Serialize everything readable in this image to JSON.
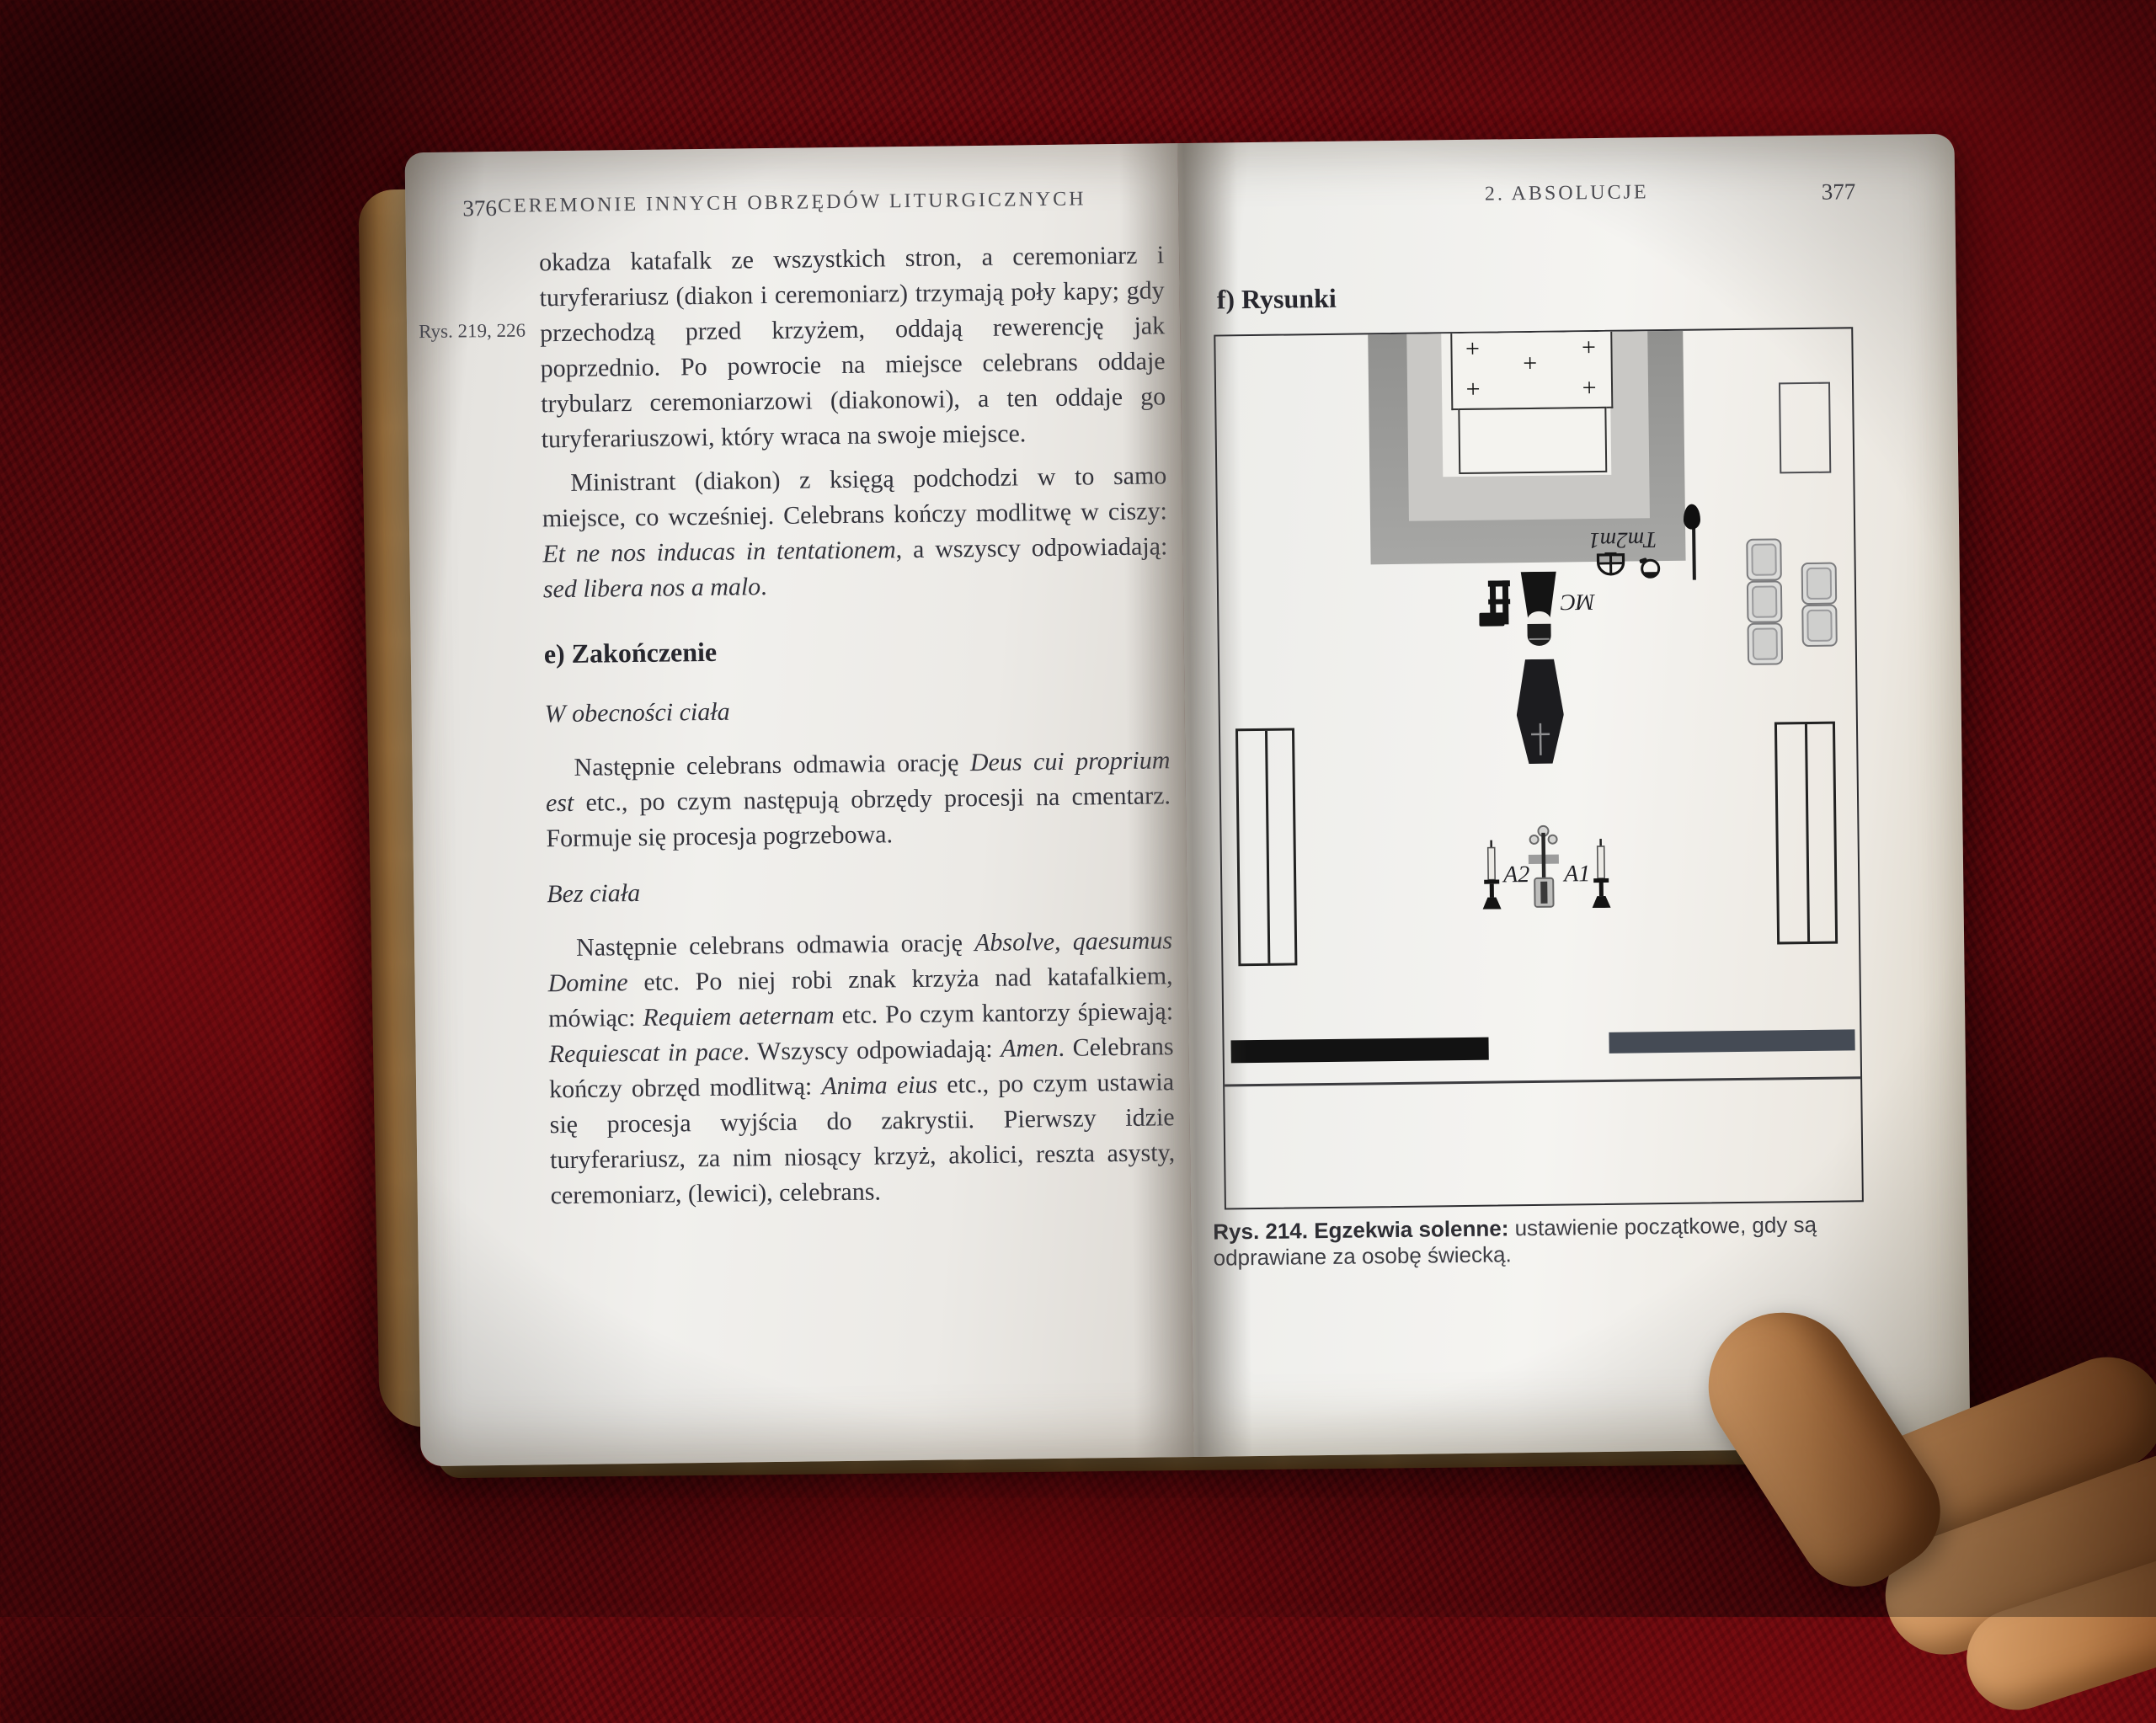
{
  "scene": {
    "background_color": "#5e070c",
    "page_color": "#f2f1ed",
    "description": "Open book held by a hand on a red plush blanket"
  },
  "left_page": {
    "page_number": "376",
    "running_header": "CEREMONIE INNYCH OBRZĘDÓW LITURGICZNYCH",
    "margin_note": "Rys. 219, 226",
    "paragraph_1": "okadza katafalk ze wszystkich stron, a ceremoniarz i turyferariusz (diakon i ceremoniarz) trzymają poły kapy; gdy przechodzą przed krzyżem, oddają rewerencję jak poprzednio. Po powrocie na miejsce celebrans oddaje trybularz ceremoniarzowi (diakonowi), a ten oddaje go turyferariuszowi, który wraca na swoje miejsce.",
    "paragraph_2_rich": [
      [
        "Ministrant (diakon) z księgą podchodzi w to samo miejsce, co wcześniej. Celebrans kończy modlitwę w ciszy: ",
        "r"
      ],
      [
        "Et ne nos inducas in tentationem",
        "i"
      ],
      [
        ", a wszyscy odpowiadają: ",
        "r"
      ],
      [
        "sed libera nos a malo",
        "i"
      ],
      [
        ".",
        "r"
      ]
    ],
    "section_heading": "e) Zakończenie",
    "subheading_1": "W obecności ciała",
    "paragraph_3_rich": [
      [
        "Następnie celebrans odmawia orację ",
        "r"
      ],
      [
        "Deus cui proprium est",
        "i"
      ],
      [
        " etc., po czym następują obrzędy procesji na cmentarz. Formuje się procesja pogrzebowa.",
        "r"
      ]
    ],
    "subheading_2": "Bez ciała",
    "paragraph_4_rich": [
      [
        "Następnie celebrans odmawia orację ",
        "r"
      ],
      [
        "Absolve, qaesumus Domine",
        "i"
      ],
      [
        " etc. Po niej robi znak krzyża nad katafalkiem, mówiąc: ",
        "r"
      ],
      [
        "Requiem aeternam",
        "i"
      ],
      [
        " etc. Po czym kantorzy śpiewają: ",
        "r"
      ],
      [
        "Requiescat in pace",
        "i"
      ],
      [
        ". Wszyscy odpowiadają: ",
        "r"
      ],
      [
        "Amen",
        "i"
      ],
      [
        ". Celebrans kończy obrzęd modlitwą: ",
        "r"
      ],
      [
        "Anima eius",
        "i"
      ],
      [
        " etc., po czym ustawia się procesja wyjścia do zakrystii. Pierwszy idzie turyferariusz, za nim niosący krzyż, akolici, reszta asysty, ceremoniarz, (lewici), celebrans.",
        "r"
      ]
    ]
  },
  "right_page": {
    "running_header": "2. ABSOLUCJE",
    "page_number": "377",
    "section_heading": "f) Rysunki",
    "figure": {
      "number": "Rys. 214.",
      "caption_lead": "Rys. 214. Egzekwia solenne:",
      "caption_rest": " ustawienie początkowe, gdy są odprawiane za osobę świecką.",
      "labels": {
        "altar_candle_glyph": "+",
        "thurifer_group": "Tm2m1",
        "master_of_ceremonies": "MC",
        "acolyte_2": "A2",
        "acolyte_1": "A1"
      }
    }
  }
}
